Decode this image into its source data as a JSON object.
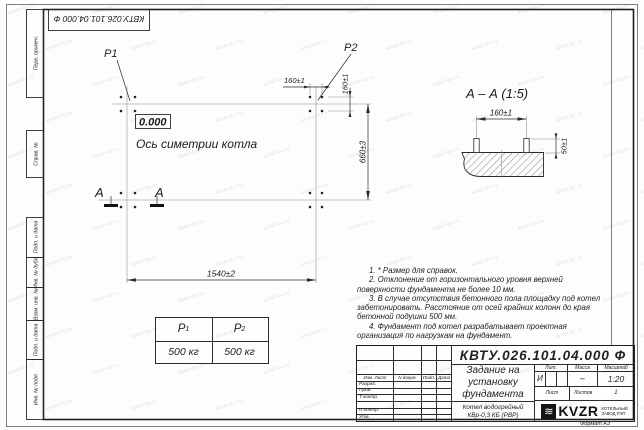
{
  "watermark": "kotel-kv.ru",
  "frame": {
    "doc_code_top": "КВТУ.026.101.04.000 Ф",
    "margin_labels": [
      "Перв. примен.",
      "Справ. №",
      "Подп. и дата",
      "Инв. № дубл.",
      "Взам. инв. №",
      "Подп. и дата",
      "Инв. № подл."
    ],
    "format_label": "Формат А3"
  },
  "plan": {
    "p1": "P1",
    "p2": "P2",
    "elevation": "0.000",
    "axis_label": "Ось симетрии котла",
    "dim_bolt_spacing_h": "160±1",
    "dim_bolt_spacing_v": "160±1",
    "dim_width": "660±3",
    "dim_length": "1540±2",
    "section_mark": "А"
  },
  "section": {
    "title": "А – А (1:5)",
    "dim_bolt_spacing": "160±1",
    "dim_bolt_height": "50±1"
  },
  "load_table": {
    "col1": {
      "base": "P",
      "sub": "1",
      "value": "500 кг"
    },
    "col2": {
      "base": "P",
      "sub": "2",
      "value": "500 кг"
    }
  },
  "notes": [
    "1. * Размер для справок.",
    "2. Отклонение от горизонтального уровня верхней поверхности фундамента не более 10 мм.",
    "3. В случае отсутствия бетонного пола площадку под котел забетонировать. Расстояние от осей крайних колонн до края бетонной подушки 500 мм.",
    "4. Фундамент под котел разрабатывает проектная организация по нагрузкам на фундамент."
  ],
  "title_block": {
    "code": "КВТУ.026.101.04.000  Ф",
    "title_lines": [
      "Задание на",
      "установку",
      "фундамента"
    ],
    "product_lines": [
      "Котел водогрейный",
      "КВр-0,3  КБ  (РВР)"
    ],
    "rev_header": [
      "Изм. Лист",
      "N докум.",
      "Подп.",
      "Дата"
    ],
    "sig_labels": [
      "Разраб.",
      "Пров.",
      "Т.контр.",
      "",
      "Н.контр.",
      "Утв."
    ],
    "lit_label": "Лит.",
    "lit_value": "И",
    "mass_label": "Масса",
    "mass_value": "–",
    "scale_label": "Масштаб",
    "scale_value": "1:20",
    "sheet_label": "Лист",
    "sheets_label": "Листов",
    "sheets_value": "1",
    "logo_wave": "≋",
    "logo_name": "KVZR",
    "logo_sub": [
      "КОТЕЛЬНЫЙ",
      "ЗАВОД РЭП"
    ]
  }
}
